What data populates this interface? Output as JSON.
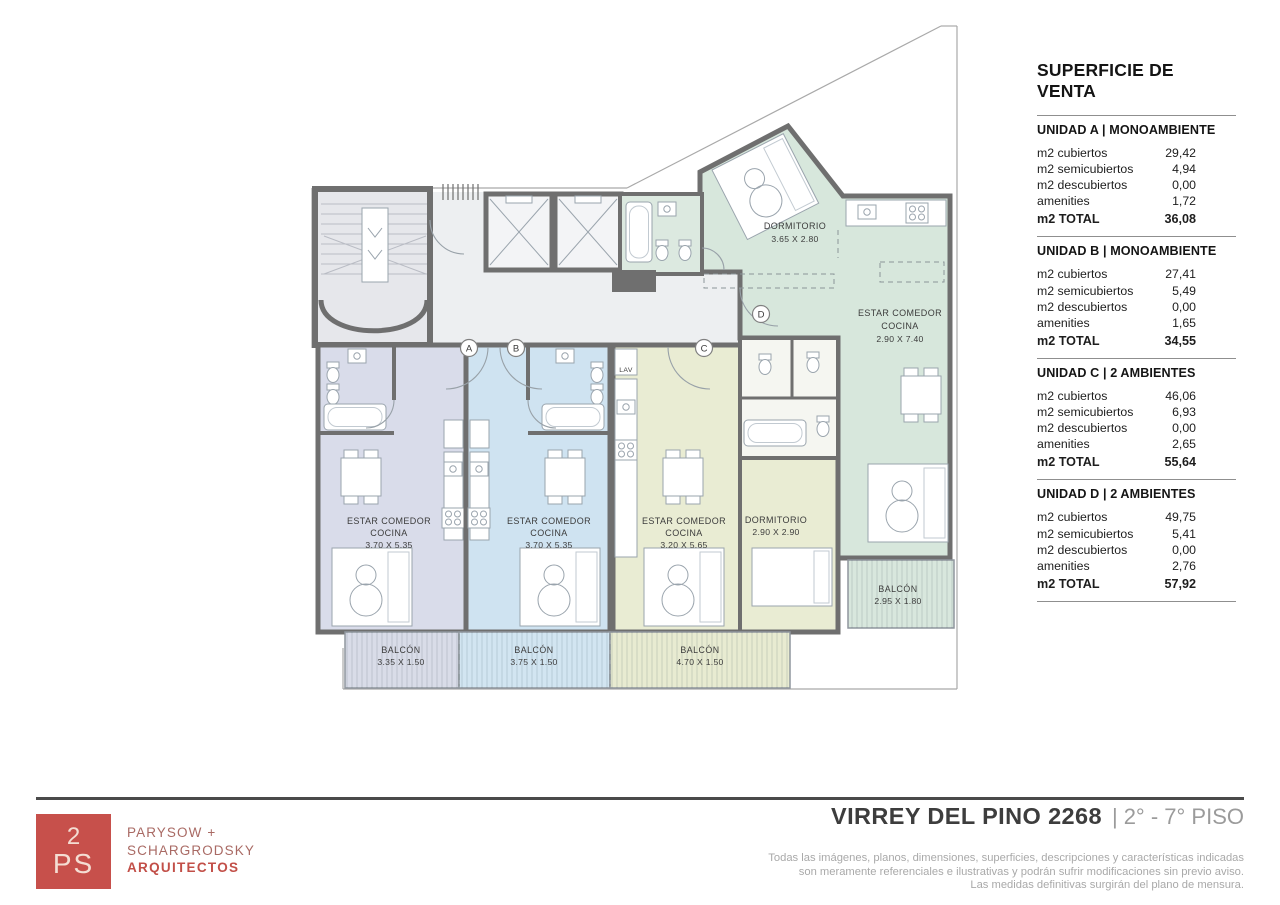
{
  "superficie": {
    "title": "SUPERFICIE DE VENTA",
    "row_labels": [
      "m2 cubiertos",
      "m2 semicubiertos",
      "m2 descubiertos",
      "amenities"
    ],
    "total_label": "m2 TOTAL",
    "units": [
      {
        "name": "UNIDAD A | MONOAMBIENTE",
        "values": [
          "29,42",
          "4,94",
          "0,00",
          "1,72"
        ],
        "total": "36,08"
      },
      {
        "name": "UNIDAD B | MONOAMBIENTE",
        "values": [
          "27,41",
          "5,49",
          "0,00",
          "1,65"
        ],
        "total": "34,55"
      },
      {
        "name": "UNIDAD C | 2 AMBIENTES",
        "values": [
          "46,06",
          "6,93",
          "0,00",
          "2,65"
        ],
        "total": "55,64"
      },
      {
        "name": "UNIDAD D | 2 AMBIENTES",
        "values": [
          "49,75",
          "5,41",
          "0,00",
          "2,76"
        ],
        "total": "57,92"
      }
    ]
  },
  "plan": {
    "unit_a": {
      "letter": "A",
      "room_line1": "ESTAR COMEDOR",
      "room_line2": "COCINA",
      "room_dims": "3.70 X 5.35",
      "balcony_label": "BALCÓN",
      "balcony_dims": "3.35 X 1.50"
    },
    "unit_b": {
      "letter": "B",
      "room_line1": "ESTAR COMEDOR",
      "room_line2": "COCINA",
      "room_dims": "3.70 X 5.35",
      "balcony_label": "BALCÓN",
      "balcony_dims": "3.75 X 1.50"
    },
    "unit_c": {
      "letter": "C",
      "room_line1": "ESTAR COMEDOR",
      "room_line2": "COCINA",
      "room_dims": "3.20 X 5.65",
      "dorm_label": "DORMITORIO",
      "dorm_dims": "2.90 X 2.90",
      "lav_label": "LAV",
      "balcony_label": "BALCÓN",
      "balcony_dims": "4.70 X 1.50"
    },
    "unit_d": {
      "letter": "D",
      "room_line1": "ESTAR COMEDOR",
      "room_line2": "COCINA",
      "room_dims": "2.90 X 7.40",
      "dorm_label": "DORMITORIO",
      "dorm_dims": "3.65 X 2.80",
      "balcony_label": "BALCÓN",
      "balcony_dims": "2.95 X 1.80"
    }
  },
  "footer": {
    "logo_top": "2",
    "logo_bottom": "PS",
    "firm_line1": "PARYSOW +",
    "firm_line2": "SCHARGRODSKY",
    "firm_line3": "ARQUITECTOS",
    "project_title": "VIRREY DEL PINO 2268",
    "title_separator": "|",
    "floors_label": "2° - 7° PISO",
    "disclaimer_line1": "Todas las imágenes, planos, dimensiones, superficies, descripciones y características indicadas",
    "disclaimer_line2": "son meramente referenciales e ilustrativas y podrán sufrir modificaciones sin previo aviso.",
    "disclaimer_line3": "Las medidas definitivas surgirán del plano de mensura."
  },
  "colors": {
    "accent_red": "#c7504b",
    "wall_gray": "#6f6f6f",
    "unit_a_fill": "#d9dcea",
    "unit_b_fill": "#cfe3f1",
    "unit_c_fill": "#e9ecd3",
    "unit_d_fill": "#d7e7dc",
    "corridor_fill": "#edeff1"
  }
}
